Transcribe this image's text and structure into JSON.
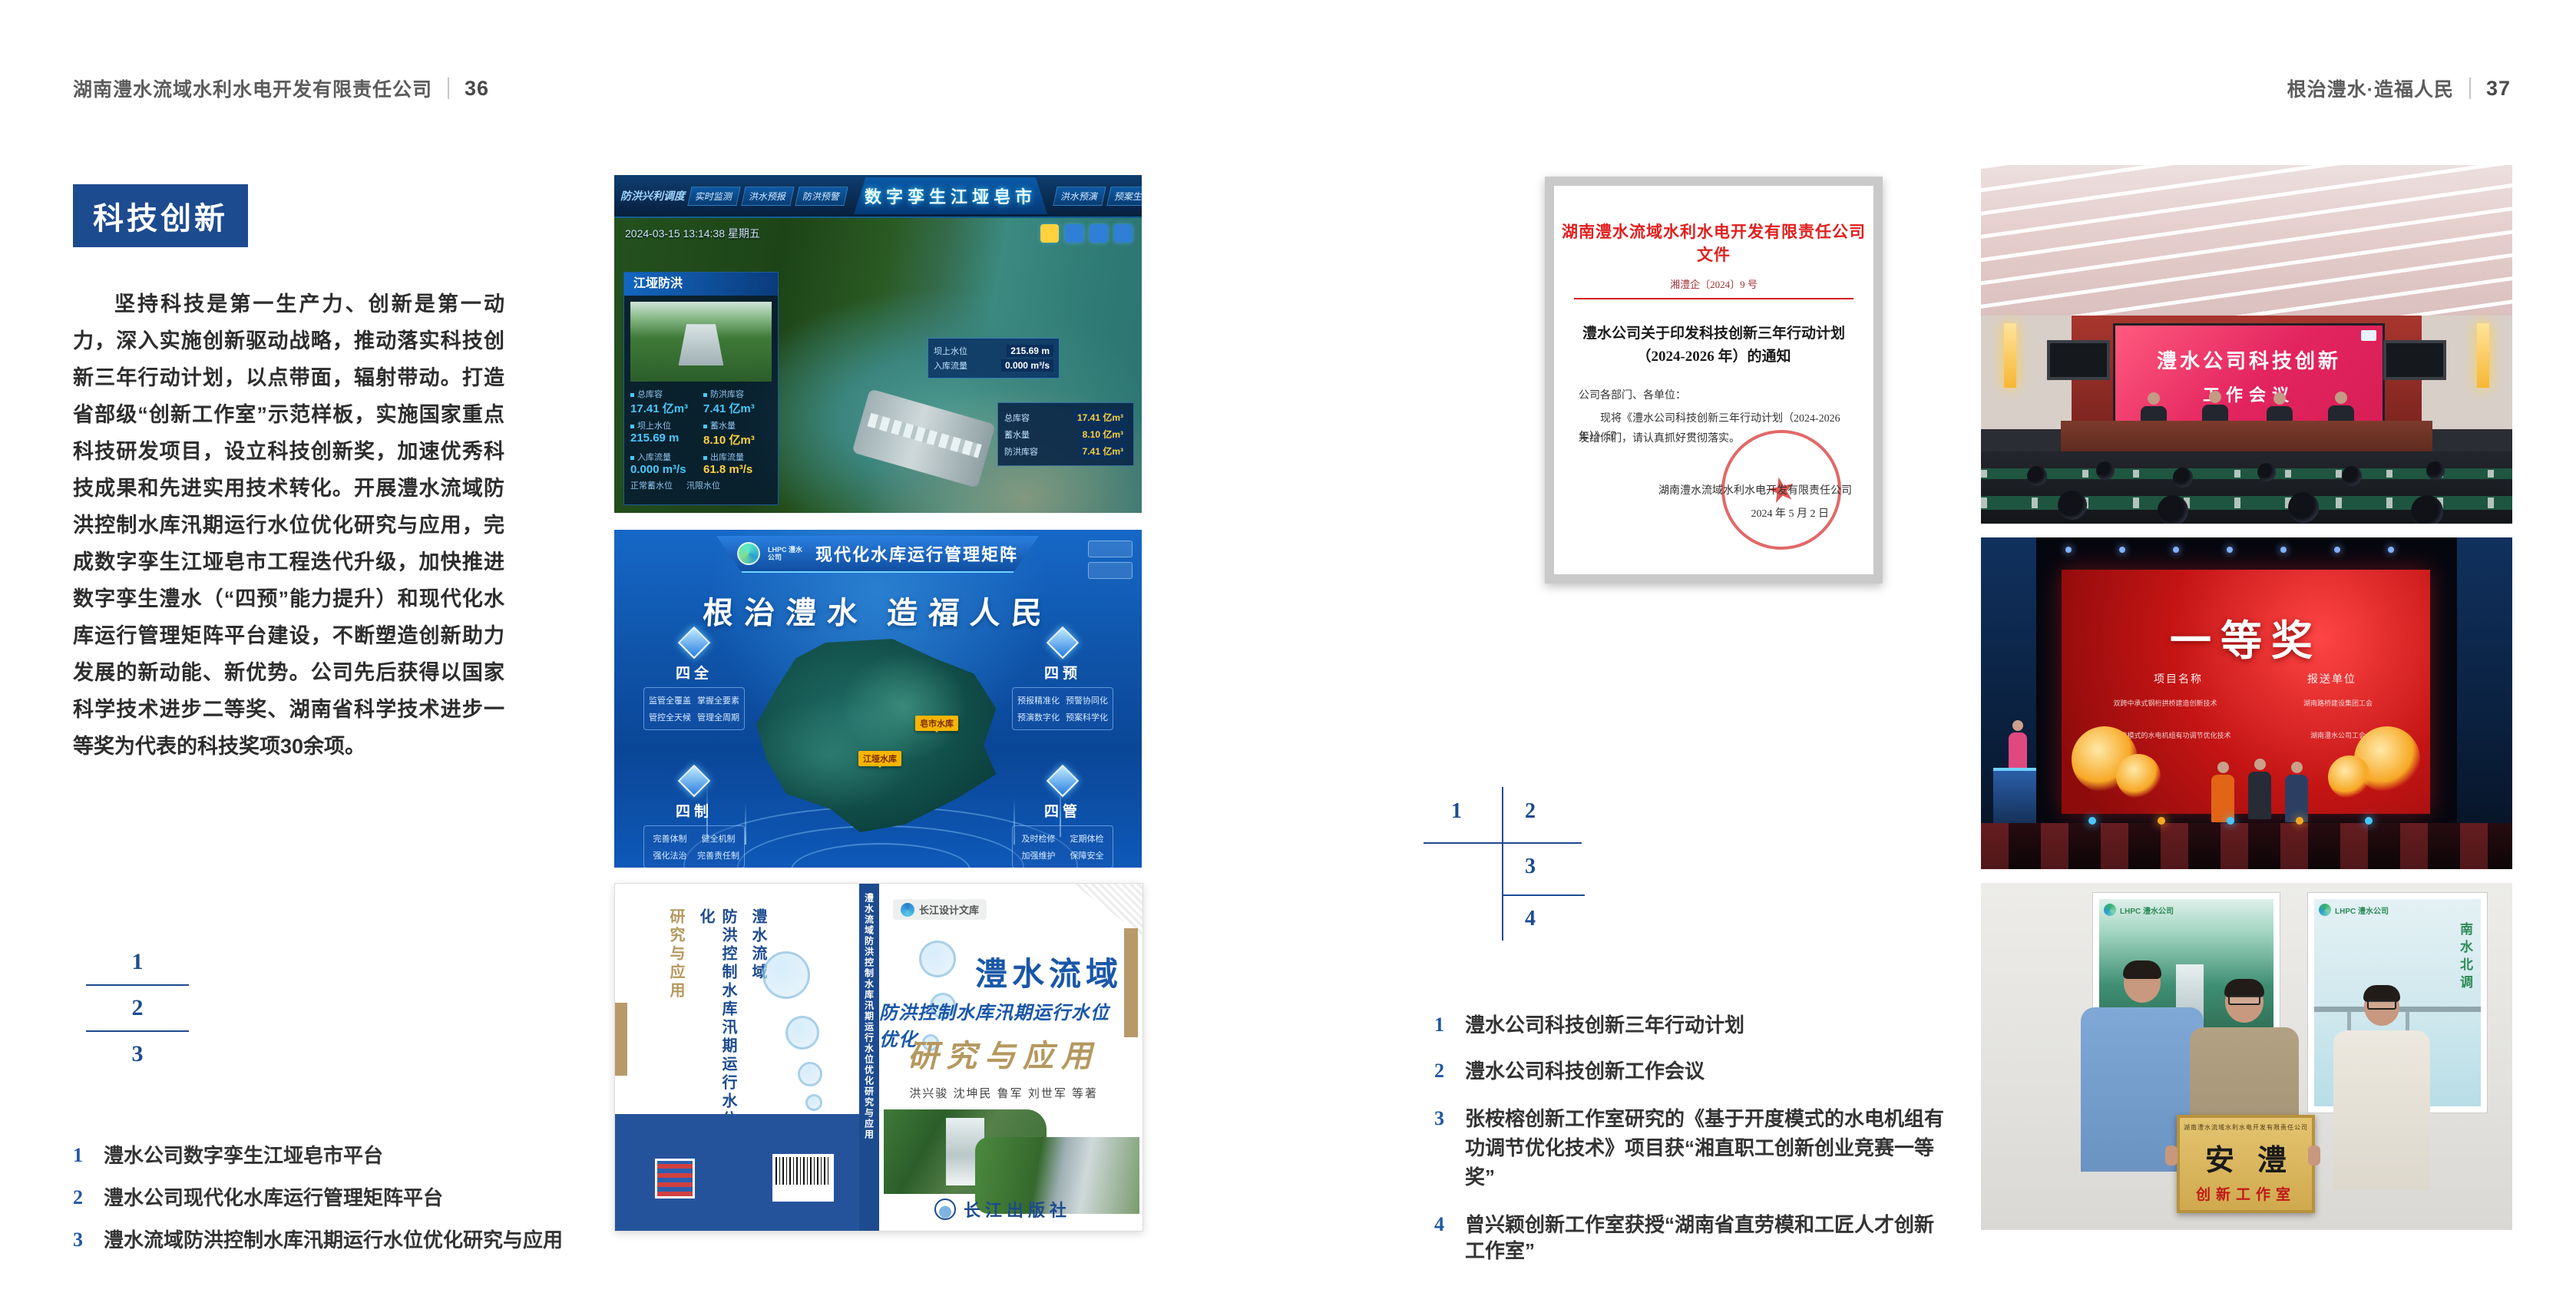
{
  "page": {
    "accent_blue": "#1d4b8f",
    "caption_blue": "#2157a4",
    "header_left": {
      "title": "湖南澧水流域水利水电开发有限责任公司",
      "page_no": "36"
    },
    "header_right": {
      "title": "根治澧水·造福人民",
      "page_no": "37"
    }
  },
  "left_page": {
    "section_badge": "科技创新",
    "body_text": "坚持科技是第一生产力、创新是第一动力，深入实施创新驱动战略，推动落实科技创新三年行动计划，以点带面，辐射带动。打造省部级“创新工作室”示范样板，实施国家重点科技研发项目，设立科技创新奖，加速优秀科技成果和先进实用技术转化。开展澧水流域防洪控制水库汛期运行水位优化研究与应用，完成数字孪生江垭皂市工程迭代升级，加快推进数字孪生澧水（“四预”能力提升）和现代化水库运行管理矩阵平台建设，不断塑造创新助力发展的新动能、新优势。公司先后获得以国家科学技术进步二等奖、湖南省科学技术进步一等奖为代表的科技奖项30余项。",
    "figure_index": [
      "1",
      "2",
      "3"
    ],
    "captions": [
      {
        "num": "1",
        "text": "澧水公司数字孪生江垭皂市平台"
      },
      {
        "num": "2",
        "text": "澧水公司现代化水库运行管理矩阵平台"
      },
      {
        "num": "3",
        "text": "澧水流域防洪控制水库汛期运行水位优化研究与应用"
      }
    ]
  },
  "digital_twin": {
    "left_menu": "防洪兴利调度",
    "tabs_left": [
      "实时监测",
      "洪水预报",
      "防洪预警"
    ],
    "tabs_right": [
      "洪水预演",
      "预案生成",
      "调度执行",
      "工程导览"
    ],
    "title": "数字孪生江垭皂市",
    "datetime": "2024-03-15 13:14:38 星期五",
    "panel_title": "江垭防洪",
    "stats": [
      {
        "label": "总库容",
        "value": "17.41 亿m³"
      },
      {
        "label": "防洪库容",
        "value": "7.41 亿m³"
      },
      {
        "label": "坝上水位",
        "value": "215.69 m"
      },
      {
        "label": "蓄水量",
        "value": "8.10 亿m³"
      },
      {
        "label": "入库流量",
        "value": "0.000 m³/s"
      },
      {
        "label": "出库流量",
        "value": "61.8 m³/s"
      }
    ],
    "extra_labels": [
      "正常蓄水位",
      "汛限水位"
    ],
    "scene_tag": {
      "rows": [
        {
          "label": "坝上水位",
          "value": "215.69 m"
        },
        {
          "label": "入库流量",
          "value": "0.000 m³/s"
        }
      ]
    },
    "info_rows": [
      {
        "label": "总库容",
        "value": "17.41 亿m³"
      },
      {
        "label": "蓄水量",
        "value": "8.10 亿m³"
      },
      {
        "label": "防洪库容",
        "value": "7.41 亿m³"
      }
    ]
  },
  "matrix_platform": {
    "logo": "LHPC 澧水公司",
    "title": "现代化水库运行管理矩阵",
    "slogan": "根治澧水 造福人民",
    "panels": [
      {
        "name": "四全",
        "items": [
          "监管全覆盖",
          "掌握全要素",
          "管控全天候",
          "管理全周期"
        ]
      },
      {
        "name": "四预",
        "items": [
          "预报精准化",
          "预警协同化",
          "预演数字化",
          "预案科学化"
        ]
      },
      {
        "name": "四制",
        "items": [
          "完善体制",
          "健全机制",
          "强化法治",
          "完善责任制"
        ]
      },
      {
        "name": "四管",
        "items": [
          "及时检修",
          "定期体检",
          "加强维护",
          "保障安全"
        ]
      }
    ],
    "map_tags": [
      "皂市水库",
      "江垭水库"
    ]
  },
  "book_cover": {
    "series": "长江设计文库",
    "title_line1": "澧水流域",
    "title_line2": "防洪控制水库汛期运行水位优化",
    "title_line3": "研究与应用",
    "authors": "洪兴骏 沈坤民 鲁军 刘世军 等著",
    "spine_text": "澧水流域防洪控制水库汛期运行水位优化研究与应用",
    "publisher": "长江出版社"
  },
  "right_page": {
    "document": {
      "header": "湖南澧水流域水利水电开发有限责任公司文件",
      "doc_no": "湘澧企〔2024〕9 号",
      "title_line1": "澧水公司关于印发科技创新三年行动计划",
      "title_line2": "（2024-2026 年）的通知",
      "salutation": "公司各部门、各单位：",
      "body_line1": "现将《澧水公司科技创新三年行动计划（2024-2026 年）》印",
      "body_line2": "发给你们，请认真抓好贯彻落实。",
      "seal_star": "★",
      "signer": "湖南澧水流域水利水电开发有限责任公司",
      "date": "2024 年 5 月 2 日"
    },
    "figure_index": [
      "1",
      "2",
      "3",
      "4"
    ],
    "captions": [
      {
        "num": "1",
        "text": "澧水公司科技创新三年行动计划"
      },
      {
        "num": "2",
        "text": "澧水公司科技创新工作会议"
      },
      {
        "num": "3",
        "text": "张桉榕创新工作室研究的《基于开度模式的水电机组有功调节优化技术》项目获“湘直职工创新创业竞赛一等奖”"
      },
      {
        "num": "4",
        "text": "曾兴颖创新工作室获授“湖南省直劳模和工匠人才创新工作室”"
      }
    ],
    "meeting_photo": {
      "screen_line1": "澧水公司科技创新",
      "screen_line2": "工作会议"
    },
    "award_photo": {
      "award": "一等奖",
      "col1": "项目名称",
      "col2": "报送单位",
      "rows": [
        {
          "project": "双跨中承式钢桁拱桥建造创新技术",
          "unit": "湖南路桥建设集团工会"
        },
        {
          "project": "基于开度模式的水电机组有功调节优化技术",
          "unit": "湖南澧水公司工会"
        }
      ]
    },
    "plaque_photo": {
      "poster_logo": "LHPC 澧水公司",
      "poster_right_text": "南水北调",
      "plaque_header": "湖南澧水流域水利水电开发有限责任公司",
      "plaque_main": "安澧",
      "plaque_sub": "创新工作室"
    }
  }
}
